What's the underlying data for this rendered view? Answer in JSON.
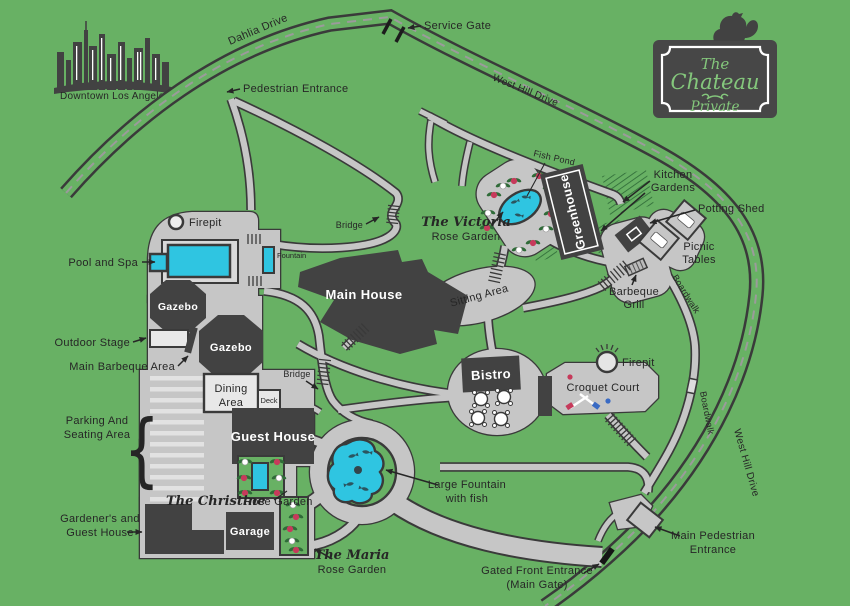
{
  "title": "The Chateau estate map",
  "colors": {
    "bg": "#68B164",
    "path": "#C6C6C6",
    "outline": "#3A3A3A",
    "building": "#424242",
    "water": "#2FC5E1",
    "ink": "#262626",
    "dash": "#9B9B9B",
    "sign_text": "#84C77C",
    "rose_red": "#C63A5B",
    "leaf": "#2F6B38",
    "light": "#E8E8E8"
  },
  "sign": {
    "line1": "The",
    "line2": "Chateau",
    "line3": "Private"
  },
  "landmark": {
    "downtown": "Downtown Los Angeles"
  },
  "roads": {
    "dahlia": "Dahlia Drive",
    "west_hill_top": "West Hill Drive",
    "west_hill_right": "West Hill Drive"
  },
  "entrances": {
    "service_gate": "Service Gate",
    "pedestrian": "Pedestrian Entrance",
    "main_pedestrian": [
      "Main Pedestrian",
      "Entrance"
    ],
    "gated_front": [
      "Gated Front Entrance",
      "(Main Gate)"
    ]
  },
  "labels": {
    "fish_pond": "Fish Pond",
    "kitchen_gardens": [
      "Kitchen",
      "Gardens"
    ],
    "potting_shed": "Potting Shed",
    "picnic_tables": [
      "Picnic",
      "Tables"
    ],
    "victoria_script": "The Victoria",
    "victoria_rest": "Rose Garden",
    "greenhouse": "Greenhouse",
    "firepit_top": "Firepit",
    "firepit_right": "Firepit",
    "pool_and_spa": "Pool and Spa",
    "fountain": "Fountain",
    "bridge_upper": "Bridge",
    "bridge_lower": "Bridge",
    "gazebo_1": "Gazebo",
    "gazebo_2": "Gazebo",
    "outdoor_stage": "Outdoor Stage",
    "main_barbeque_area": "Main Barbeque Area",
    "main_house": "Main House",
    "sitting_area": "Sitting Area",
    "barbeque_grill": [
      "Barbeque",
      "Grill"
    ],
    "boardwalk_ne": "Boardwalk",
    "boardwalk_se": "Boardwalk",
    "bistro": "Bistro",
    "croquet_court": "Croquet Court",
    "dining_area": [
      "Dining",
      "Area"
    ],
    "deck": "Deck",
    "guest_house": "Guest House",
    "parking": [
      "Parking And",
      "Seating Area"
    ],
    "parking_brace": "{",
    "christine_script": "The Christine",
    "christine_rest": "Rose Garden",
    "gardeners": [
      "Gardener's and",
      "Guest House"
    ],
    "garage": "Garage",
    "large_fountain": [
      "Large Fountain",
      "with fish"
    ],
    "maria_script": "The Maria",
    "maria_rest": "Rose Garden"
  }
}
